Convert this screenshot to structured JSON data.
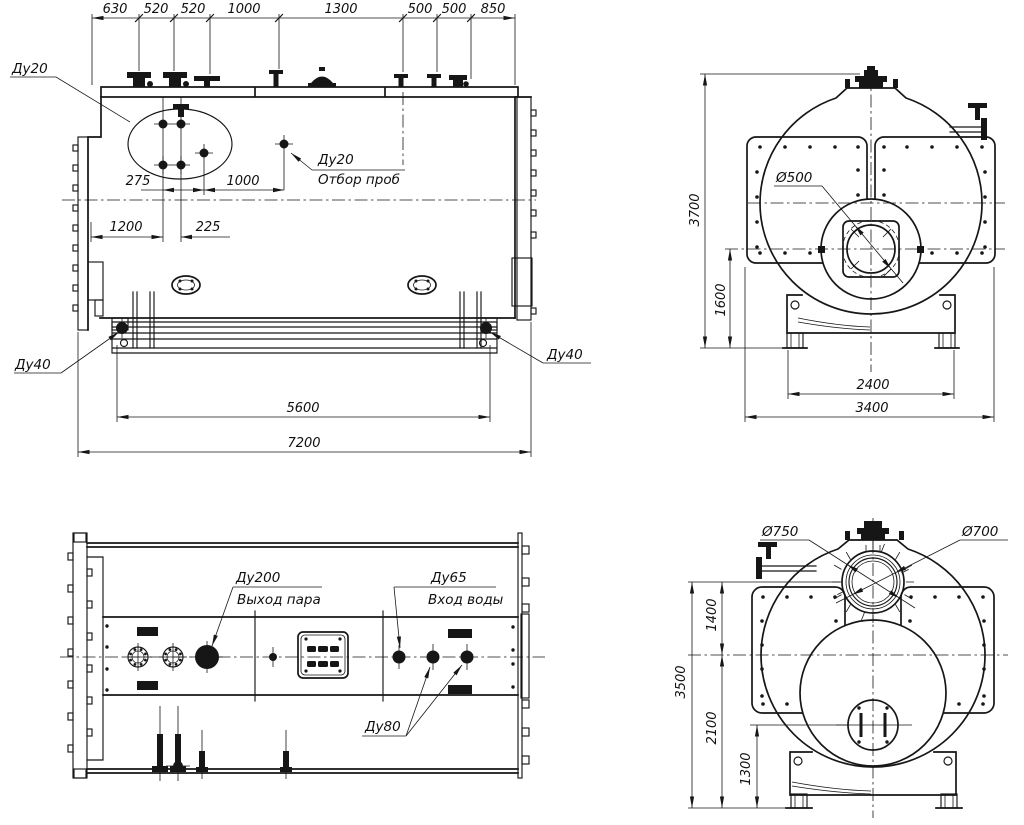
{
  "drawing": {
    "side": {
      "chain": [
        "630",
        "520",
        "520",
        "1000",
        "1300",
        "500",
        "500",
        "850"
      ],
      "dims": {
        "d275": "275",
        "d1000": "1000",
        "d1200": "1200",
        "d225": "225",
        "d5600": "5600",
        "d7200": "7200"
      },
      "labels": {
        "du20": "Ду20",
        "du20_sample": "Ду20",
        "sample": "Отбор проб",
        "du40_left": "Ду40",
        "du40_right": "Ду40"
      }
    },
    "front": {
      "labels": {
        "d500": "Ø500"
      },
      "dims": {
        "d3700": "3700",
        "d1600": "1600",
        "d2400": "2400",
        "d3400": "3400"
      }
    },
    "plan": {
      "labels": {
        "du200": "Ду200",
        "steam_out": "Выход пара",
        "du65": "Ду65",
        "water_in": "Вход воды",
        "du80": "Ду80"
      }
    },
    "rear": {
      "labels": {
        "d750": "Ø750",
        "d700": "Ø700"
      },
      "dims": {
        "d3500": "3500",
        "d1400": "1400",
        "d2100": "2100",
        "d1300": "1300"
      }
    }
  }
}
